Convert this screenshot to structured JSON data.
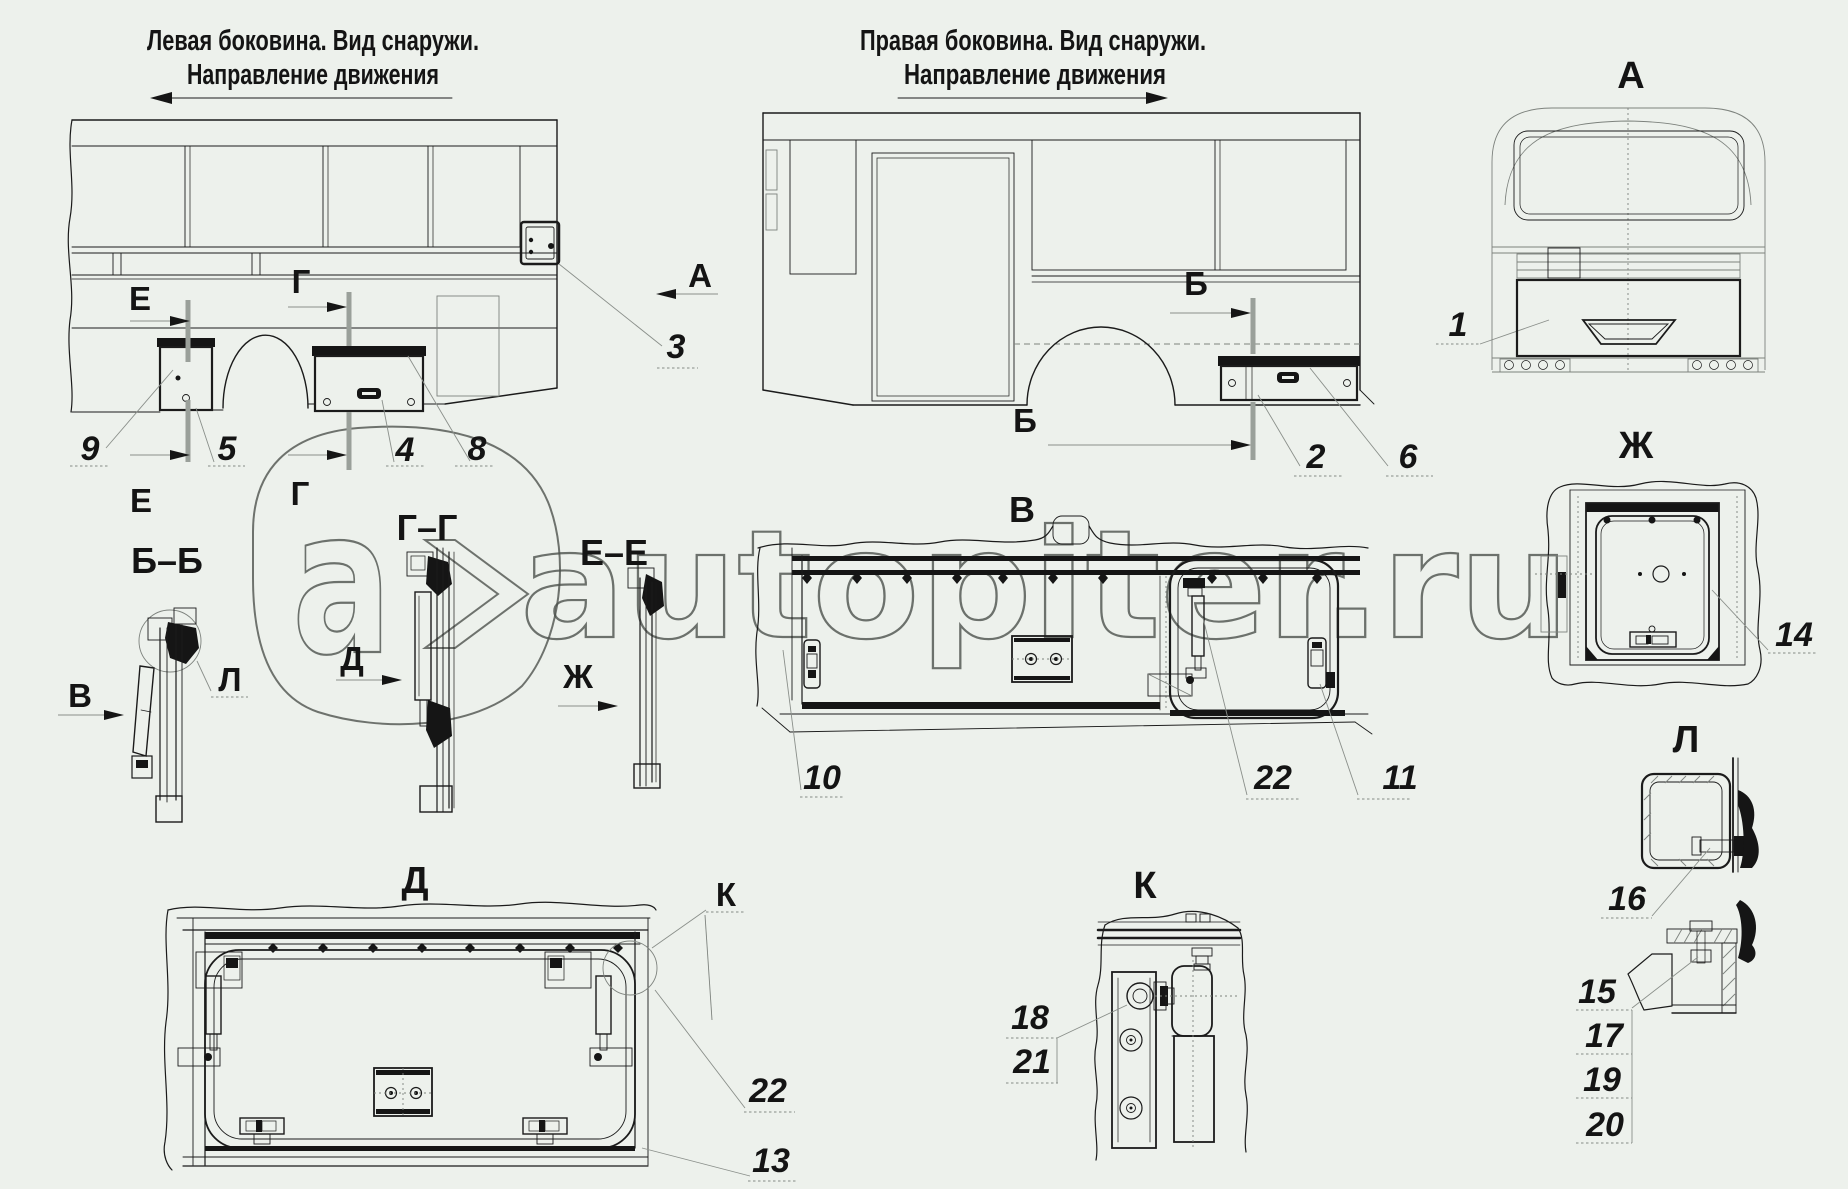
{
  "document": {
    "type": "bus-body-hatches-parts-diagram",
    "language": "ru"
  },
  "colors": {
    "background": "#edf1ec",
    "line": "#1b1b1b",
    "thin_line": "#7d827d",
    "section_line": "#9aa09a",
    "watermark": "#4d524d"
  },
  "labels": {
    "title_left_1": "Левая боковина. Вид снаружи.",
    "title_left_2": "Направление движения",
    "title_right_1": "Правая боковина. Вид снаружи.",
    "title_right_2": "Направление движения",
    "view_a": "А",
    "marker_a": "А",
    "marker_e_top": "Е",
    "marker_e_bottom": "Е",
    "marker_g_top": "Г",
    "marker_g_bottom": "Г",
    "marker_b_top": "Б",
    "marker_b_bottom": "Б",
    "section_bb": "Б–Б",
    "section_gg": "Г–Г",
    "section_ee": "Е–Е",
    "view_v": "В",
    "marker_v": "В",
    "view_d": "Д",
    "marker_d": "Д",
    "view_zh": "Ж",
    "marker_zh": "Ж",
    "view_k": "К",
    "marker_k": "К",
    "view_l": "Л",
    "marker_l": "Л"
  },
  "callouts": {
    "c1": "1",
    "c2": "2",
    "c3": "3",
    "c4": "4",
    "c5": "5",
    "c6": "6",
    "c8": "8",
    "c9": "9",
    "c10": "10",
    "c11": "11",
    "c13": "13",
    "c14": "14",
    "c15": "15",
    "c16": "16",
    "c17": "17",
    "c18": "18",
    "c19": "19",
    "c20": "20",
    "c21": "21",
    "c22_v": "22",
    "c22_d": "22"
  },
  "watermark": {
    "text": "autopiter.ru",
    "logo_letter": "a"
  }
}
